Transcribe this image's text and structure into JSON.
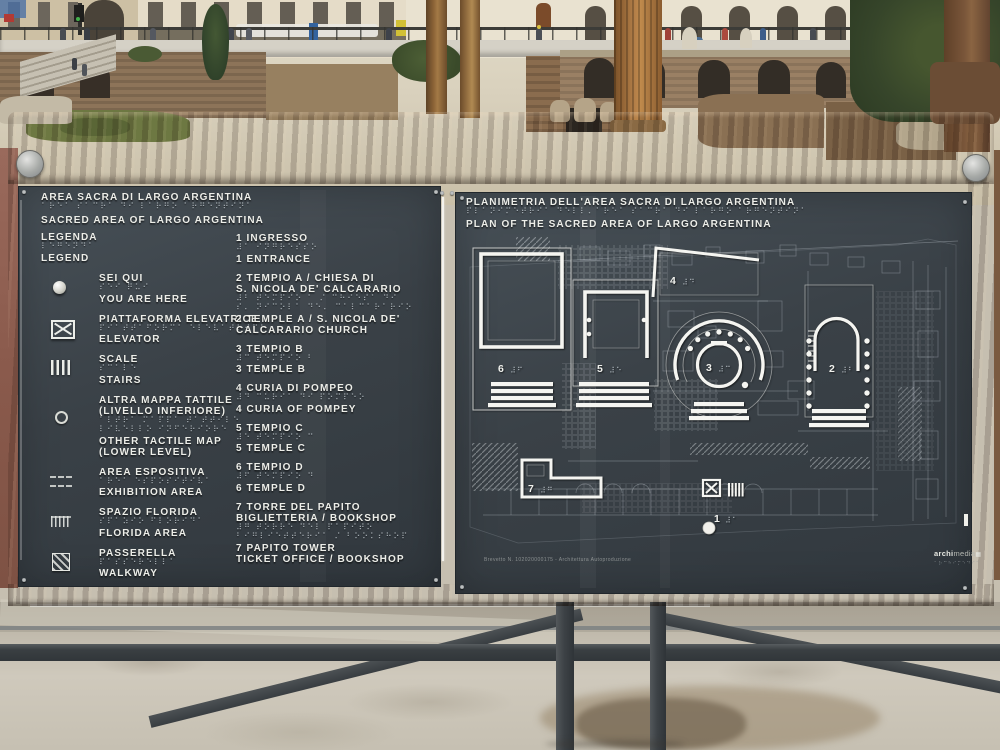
{
  "colors": {
    "panel": "#3a4147",
    "rust_frame": "#7c4e31",
    "raised_text": "#edeee9",
    "braille_dots": "#b0b8be",
    "plan_lines": "#f5f5f1"
  },
  "panel_left": {
    "title_it": "AREA SACRA DI LARGO ARGENTINA",
    "title_braille": "⠁⠗⠑⠁ ⠎⠁⠉⠗⠁ ⠙⠊ ⠇⠁⠗⠛⠕ ⠁⠗⠛⠑⠝⠞⠊⠝⠁",
    "title_en": "SACRED AREA OF LARGO ARGENTINA",
    "legend": {
      "it": "LEGENDA",
      "braille": "⠇⠑⠛⠑⠝⠙⠁",
      "en": "LEGEND"
    },
    "items": [
      {
        "icon": "you-are-here-dot",
        "it1": "SEI QUI",
        "braille1": "⠎⠑⠊ ⠟⠥⠊",
        "en1": "YOU ARE HERE"
      },
      {
        "icon": "elevator",
        "it1": "PIATTAFORMA ELEVATRICE",
        "braille1": "⠏⠊⠁⠞⠞⠁⠋⠕⠗⠍⠁ ⠑⠇⠑⠧⠁⠞⠗⠊⠉⠑",
        "en1": "ELEVATOR"
      },
      {
        "icon": "stairs",
        "it1": "SCALE",
        "braille1": "⠎⠉⠁⠇⠑",
        "en1": "STAIRS"
      },
      {
        "icon": "other-tactile-map",
        "it1": "ALTRA MAPPA TATTILE",
        "it2": "(LIVELLO INFERIORE)",
        "braille1": "⠁⠇⠞⠗⠁ ⠍⠁⠏⠏⠁ ⠞⠁⠞⠞⠊⠇⠑",
        "braille2": "⠇⠊⠧⠑⠇⠇⠕ ⠊⠝⠋⠑⠗⠊⠕⠗⠑",
        "en1": "OTHER TACTILE MAP",
        "en2": "(LOWER LEVEL)"
      },
      {
        "icon": "exhibition-area",
        "it1": "AREA ESPOSITIVA",
        "braille1": "⠁⠗⠑⠁ ⠑⠎⠏⠕⠎⠊⠞⠊⠧⠁",
        "en1": "EXHIBITION AREA"
      },
      {
        "icon": "florida-area",
        "it1": "SPAZIO FLORIDA",
        "braille1": "⠎⠏⠁⠵⠊⠕ ⠋⠇⠕⠗⠊⠙⠁",
        "en1": "FLORIDA AREA"
      },
      {
        "icon": "walkway",
        "it1": "PASSERELLA",
        "braille1": "⠏⠁⠎⠎⠑⠗⠑⠇⠇⠁",
        "en1": "WALKWAY"
      }
    ],
    "numbered": [
      {
        "it1": "1 INGRESSO",
        "braille1": "⠼⠁ ⠊⠝⠛⠗⠑⠎⠎⠕",
        "en1": "1 ENTRANCE"
      },
      {
        "it1": "2 TEMPIO A / CHIESA DI",
        "it2": "S. NICOLA DE' CALCARARIO",
        "braille1": "⠼⠃ ⠞⠑⠍⠏⠊⠕ ⠁ ⠌ ⠉⠓⠊⠑⠎⠁ ⠙⠊",
        "braille2": "⠎⠄ ⠝⠊⠉⠕⠇⠁ ⠙⠑⠄ ⠉⠁⠇⠉⠁⠗⠁⠗⠊⠕",
        "en1": "2 TEMPLE A / S. NICOLA DE'",
        "en2": "CALCARARIO CHURCH"
      },
      {
        "it1": "3 TEMPIO B",
        "braille1": "⠼⠉ ⠞⠑⠍⠏⠊⠕ ⠃",
        "en1": "3 TEMPLE B"
      },
      {
        "it1": "4 CURIA DI POMPEO",
        "braille1": "⠼⠙ ⠉⠥⠗⠊⠁ ⠙⠊ ⠏⠕⠍⠏⠑⠕",
        "en1": "4 CURIA OF POMPEY"
      },
      {
        "it1": "5 TEMPIO C",
        "braille1": "⠼⠑ ⠞⠑⠍⠏⠊⠕ ⠉",
        "en1": "5 TEMPLE C"
      },
      {
        "it1": "6 TEMPIO D",
        "braille1": "⠼⠋ ⠞⠑⠍⠏⠊⠕ ⠙",
        "en1": "6 TEMPLE D"
      },
      {
        "it1": "7 TORRE DEL PAPITO",
        "it2": "BIGLIETTERIA / BOOKSHOP",
        "braille1": "⠼⠛ ⠞⠕⠗⠗⠑ ⠙⠑⠇ ⠏⠁⠏⠊⠞⠕",
        "braille2": "⠃⠊⠛⠇⠊⠑⠞⠞⠑⠗⠊⠁ ⠌ ⠃⠕⠕⠅⠎⠓⠕⠏",
        "en1": "7 PAPITO TOWER",
        "en2": "TICKET OFFICE / BOOKSHOP"
      }
    ]
  },
  "panel_right": {
    "title_it": "PLANIMETRIA DELL'AREA SACRA DI LARGO ARGENTINA",
    "title_braille": "⠏⠇⠁⠝⠊⠍⠑⠞⠗⠊⠁ ⠙⠑⠇⠇⠄⠁⠗⠑⠁ ⠎⠁⠉⠗⠁ ⠙⠊ ⠇⠁⠗⠛⠕ ⠁⠗⠛⠑⠝⠞⠊⠝⠁",
    "title_en": "PLAN OF THE SACRED AREA OF LARGO ARGENTINA",
    "plan_labels": [
      {
        "n": "1",
        "braille": "⠼⠁"
      },
      {
        "n": "2",
        "braille": "⠼⠃"
      },
      {
        "n": "3",
        "braille": "⠼⠉"
      },
      {
        "n": "4",
        "braille": "⠼⠙"
      },
      {
        "n": "5",
        "braille": "⠼⠑"
      },
      {
        "n": "6",
        "braille": "⠼⠋"
      },
      {
        "n": "7",
        "braille": "⠼⠛"
      }
    ],
    "footer_note": "Brevetto N. 102020000175 - Architettura Autoproduzione",
    "maker_bold": "archi",
    "maker_light": "media",
    "maker_mark": "▦",
    "maker_braille": "⠁⠗⠉⠓⠊⠍⠑⠙⠊⠁"
  }
}
